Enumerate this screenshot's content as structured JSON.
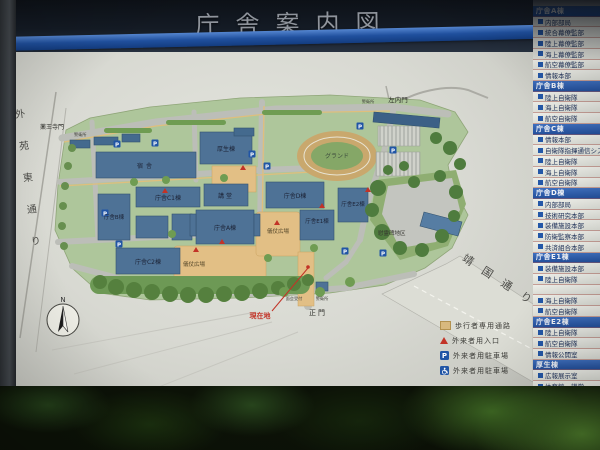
{
  "sign": {
    "title": "庁舎案内図"
  },
  "directory": {
    "rows": [
      {
        "t": "h",
        "label": "庁舎A棟"
      },
      {
        "t": "i",
        "label": "内部部局"
      },
      {
        "t": "i",
        "label": "統合幕僚監部"
      },
      {
        "t": "i",
        "label": "陸上幕僚監部"
      },
      {
        "t": "i",
        "label": "海上幕僚監部"
      },
      {
        "t": "i",
        "label": "航空幕僚監部"
      },
      {
        "t": "i",
        "label": "情報本部"
      },
      {
        "t": "h",
        "label": "庁舎B棟"
      },
      {
        "t": "i",
        "label": "陸上自衛隊"
      },
      {
        "t": "i",
        "label": "海上自衛隊"
      },
      {
        "t": "i",
        "label": "航空自衛隊"
      },
      {
        "t": "h",
        "label": "庁舎C棟"
      },
      {
        "t": "i",
        "label": "情報本部"
      },
      {
        "t": "i",
        "label": "自衛隊指揮通信システム隊"
      },
      {
        "t": "i",
        "label": "陸上自衛隊"
      },
      {
        "t": "i",
        "label": "海上自衛隊"
      },
      {
        "t": "i",
        "label": "航空自衛隊"
      },
      {
        "t": "h",
        "label": "庁舎D棟"
      },
      {
        "t": "i",
        "label": "内部部局"
      },
      {
        "t": "i",
        "label": "技術研究本部"
      },
      {
        "t": "i",
        "label": "装備施設本部"
      },
      {
        "t": "i",
        "label": "防衛監察本部"
      },
      {
        "t": "i",
        "label": "共済組合本部"
      },
      {
        "t": "h",
        "label": "庁舎E1棟"
      },
      {
        "t": "i",
        "label": "装備施設本部"
      },
      {
        "t": "i",
        "label": "陸上自衛隊"
      },
      {
        "t": "i",
        "label": ""
      },
      {
        "t": "i",
        "label": "海上自衛隊"
      },
      {
        "t": "i",
        "label": "航空自衛隊"
      },
      {
        "t": "h",
        "label": "庁舎E2棟"
      },
      {
        "t": "i",
        "label": "陸上自衛隊"
      },
      {
        "t": "i",
        "label": "航空自衛隊"
      },
      {
        "t": "i",
        "label": "情報公開室"
      },
      {
        "t": "h",
        "label": "厚生棟"
      },
      {
        "t": "i",
        "label": "広報展示室"
      },
      {
        "t": "i",
        "label": "体育館・講堂"
      }
    ]
  },
  "map": {
    "labels": {
      "gate_yakuoji": "薬王寺門",
      "gate_sanai": "左内門",
      "gate_main": "正門",
      "guard_post": "警衛所",
      "reception": "面会受付",
      "you_are_here": "現在地",
      "street_gaien": "外苑東通り",
      "street_yasukuni": "靖国通り",
      "building_kosei": "厚生棟",
      "building_shukusha": "宿舎",
      "building_a": "庁舎A棟",
      "building_b": "庁舎B棟",
      "building_c1": "庁舎C1棟",
      "building_c2": "庁舎C2棟",
      "building_d": "庁舎D棟",
      "building_e1": "庁舎E1棟",
      "building_e2": "庁舎E2棟",
      "building_kodo": "講堂",
      "ground": "グランド",
      "gijo_plaza": "儀仗広場",
      "memorial_area": "慰霊碑地区",
      "north": "N",
      "parking_p": "P"
    },
    "board_legend": [
      {
        "icon": "pedestrian-path-square",
        "label": "歩行者専用通路"
      },
      {
        "icon": "visitor-entrance-triangle",
        "label": "外来者用入口"
      },
      {
        "icon": "visitor-parking-p",
        "label": "外来者用駐車場"
      },
      {
        "icon": "accessible-parking-wheelchair",
        "label": "外来者用駐車場"
      }
    ]
  },
  "colors": {
    "board": "#d9dad2",
    "campus_green": "#aec69b",
    "building_blue": "#4e7296",
    "plaza_tan": "#e2bf85",
    "directory_header_blue": "#2d5cab",
    "marker_red": "#c23327",
    "parking_blue": "#2155a5",
    "header_stripe_blue": "#1c4d9e"
  }
}
